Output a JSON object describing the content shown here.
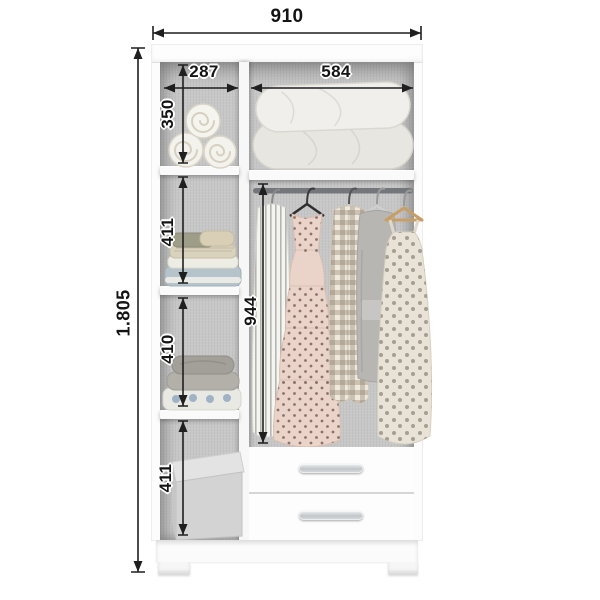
{
  "dims": {
    "overall_width": "910",
    "overall_height": "1.805",
    "left_column_width": "287",
    "right_column_width": "584",
    "left_shelf_1_height": "350",
    "left_shelf_2_height": "411",
    "left_shelf_3_height": "410",
    "left_shelf_4_height": "411",
    "hanging_section_height": "944"
  },
  "colors": {
    "dimension_ink": "#1f1f1f",
    "cabinet_white": "#fcfcfc",
    "interior_grey": "#c7c7c7",
    "rail_grey": "#73777b",
    "handle_silver": "#c2c6c9",
    "background": "#ffffff"
  }
}
